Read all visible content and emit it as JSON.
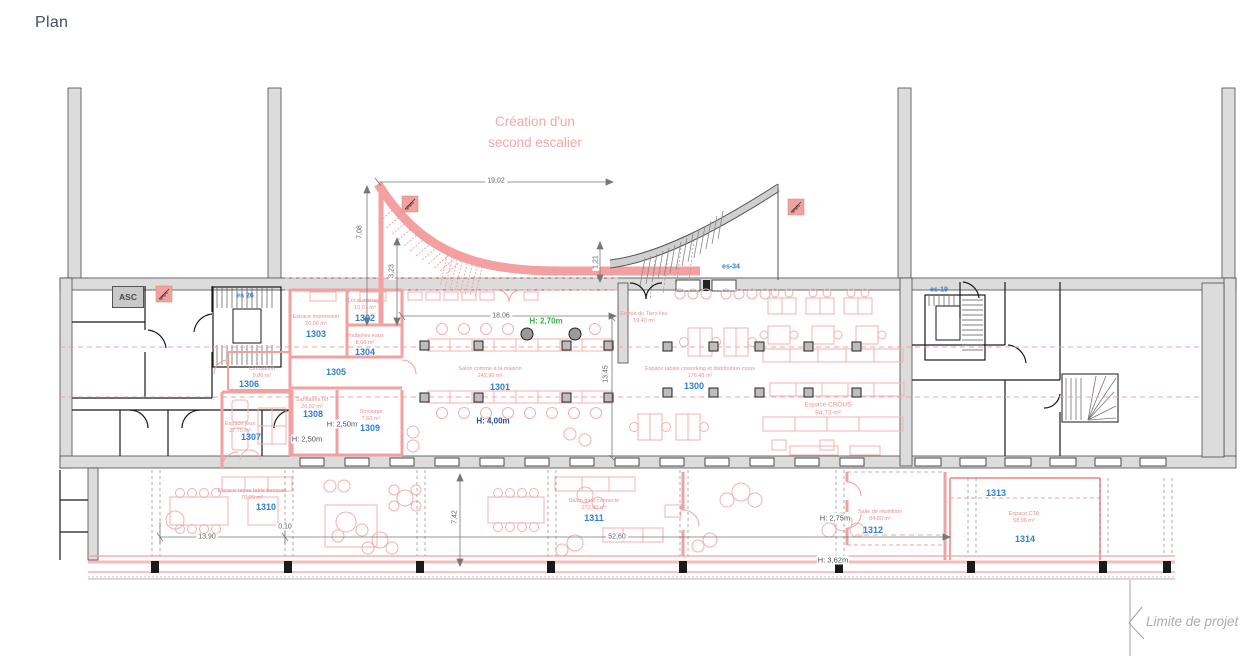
{
  "page": {
    "title": "Plan"
  },
  "annotation": {
    "line1": "Création d'un",
    "line2": "second escalier"
  },
  "limit": {
    "label": "Limite de projet"
  },
  "elevator": {
    "label": "ASC"
  },
  "stairs": {
    "es26": "es 26",
    "es34": "es-34",
    "es19": "es-19"
  },
  "icons": {
    "new_stair_left": "stair-icon",
    "new_stair_right": "stair-icon",
    "small_stair": "stair-icon"
  },
  "rooms": [
    {
      "number": "1300",
      "name": "Espace tables coworking et distribution crous",
      "area": "176,43 m²"
    },
    {
      "number": "1301",
      "name": "Salon comme à la maison",
      "area": "242,90 m²"
    },
    {
      "number": "1302",
      "name": "Local ménage",
      "area": "10,07 m²"
    },
    {
      "number": "1303",
      "name": "Espace impression",
      "area": "20,06 m²"
    },
    {
      "number": "1304",
      "name": "Poubelles eaux",
      "area": "8,06 m²"
    },
    {
      "number": "1305"
    },
    {
      "number": "1306",
      "name": "Circulation",
      "area": "9,86 m²"
    },
    {
      "number": "1307",
      "name": "Espace jeux",
      "area": "27,75 m²"
    },
    {
      "number": "1308",
      "name": "Sanitaires h/f",
      "area": "26,82 m²"
    },
    {
      "number": "1309",
      "name": "Stockage",
      "area": "7,60 m²"
    },
    {
      "number": "1310",
      "name": "Espace repas table banquet",
      "area": "70,29 m²"
    },
    {
      "number": "1311",
      "name": "Salon gare connecté",
      "area": "272,80 m²"
    },
    {
      "number": "1312",
      "name": "Salle de répétition",
      "area": "84,80 m²"
    },
    {
      "number": "1313"
    },
    {
      "number": "1314",
      "name": "Espace CTA",
      "area": "58,96 m²"
    }
  ],
  "spaces": {
    "entree": {
      "name": "Entrée du Tiers lieu",
      "area": "19,40 m²"
    },
    "crous": {
      "name": "Espace CROUS",
      "area": "94,73 m²"
    }
  },
  "heights": {
    "h270": "H: 2,70m",
    "h400": "H: 4,00m",
    "h250a": "H: 2,50m",
    "h250b": "H: 2,50m",
    "h275": "H: 2,75m",
    "h362": "H: 3,62m"
  },
  "dims": {
    "d1902": "19,02",
    "d708": "7,08",
    "d323": "3,23",
    "d121": "1,21",
    "d1806": "18,06",
    "d1345": "13,45",
    "d742": "7,42",
    "d1390": "13,90",
    "d010": "0,10",
    "d5260": "52,60"
  },
  "colors": {
    "pink_wall": "#f2a0a0",
    "pink_text": "#ef8e8e",
    "room_number_blue": "#2e7fd8",
    "height_green": "#33b24c",
    "height_navy": "#1d4f9e",
    "gray_wall": "#dcdcdc",
    "dim_gray": "#5f6368",
    "title_color": "#3f5459"
  }
}
